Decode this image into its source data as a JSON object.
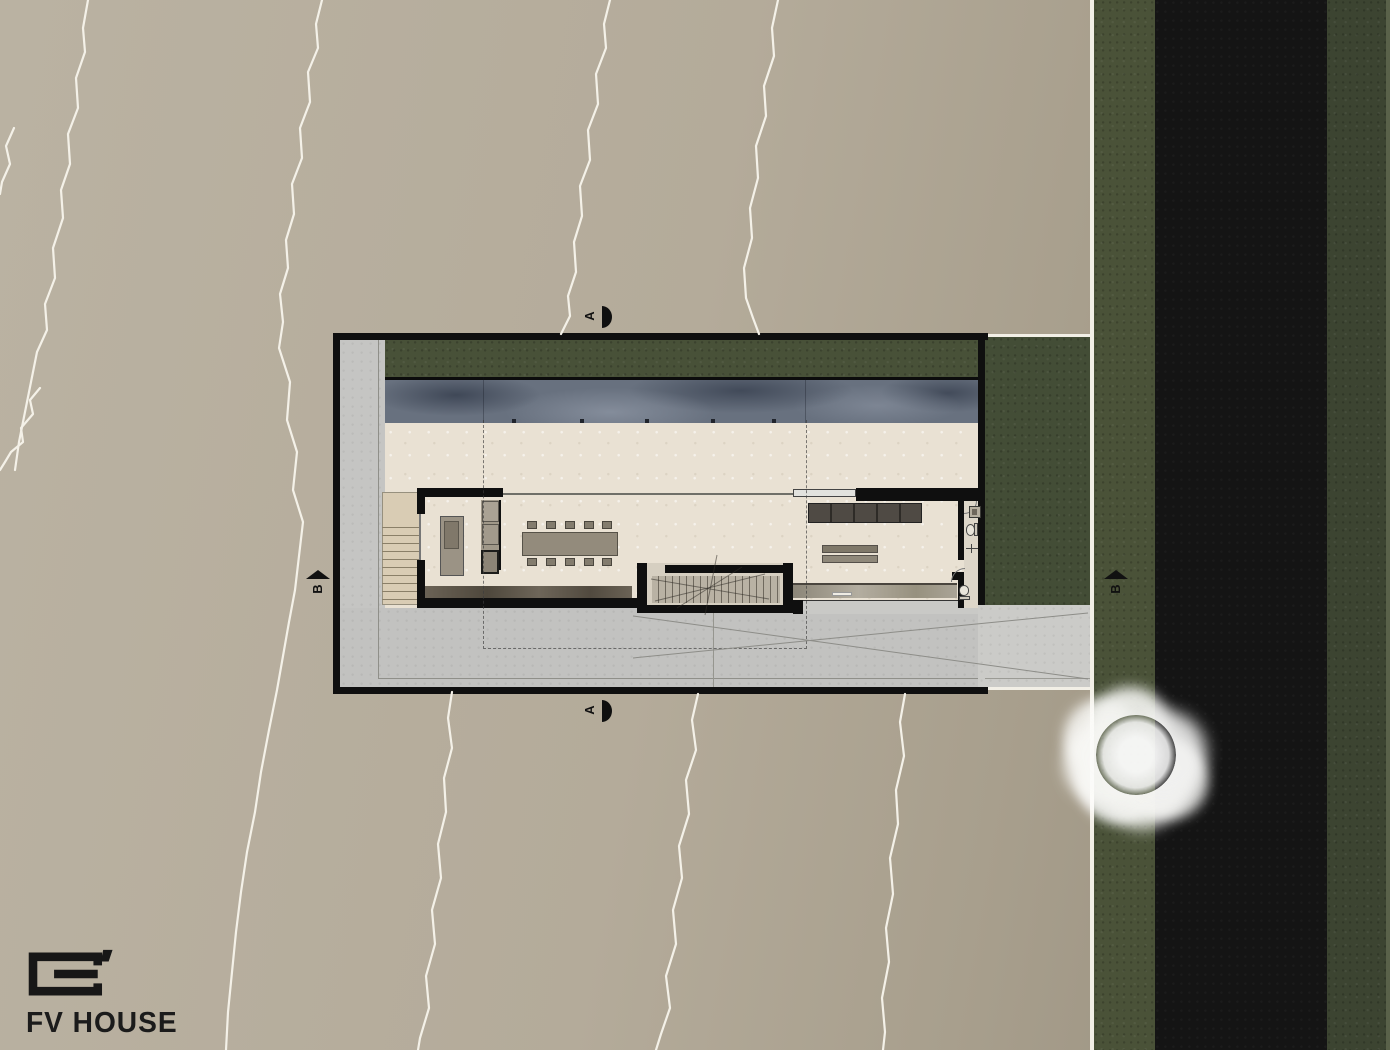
{
  "logo": {
    "text": "FV HOUSE",
    "mark": "square-g-monogram"
  },
  "section_markers": {
    "a_top": {
      "label": "A"
    },
    "a_bottom": {
      "label": "A"
    },
    "b_left": {
      "label": "B"
    },
    "b_right": {
      "label": "B"
    }
  },
  "plan": {
    "type": "architectural-site-plan",
    "drawing": "ground floor / roof terrace plan",
    "elements": [
      "site-boundary",
      "perimeter-hedge",
      "lap-pool",
      "terrace",
      "kitchen-dining-room",
      "kitchen-island",
      "appliance-column",
      "dining-table",
      "central-staircase",
      "living-room",
      "tv-console",
      "coffee-table",
      "bathroom",
      "entry-stairs",
      "roof-overhang-outline",
      "driveway",
      "side-garden",
      "street",
      "verge-green",
      "tree",
      "crack-texture-lines"
    ]
  },
  "colors": {
    "ground": "#b1a896",
    "concrete": "#c5c5c3",
    "terrace": "#e9e1d3",
    "pool": "#68717f",
    "hedge": "#485138",
    "garden": "#434d36",
    "street": "#141414",
    "green_verge": "#4a5238",
    "green_far": "#3c4431",
    "walls": "#0f0f0f",
    "crack_lines": "#f4f1e8",
    "tree": "#ffffff",
    "text": "#1b1b1b"
  }
}
